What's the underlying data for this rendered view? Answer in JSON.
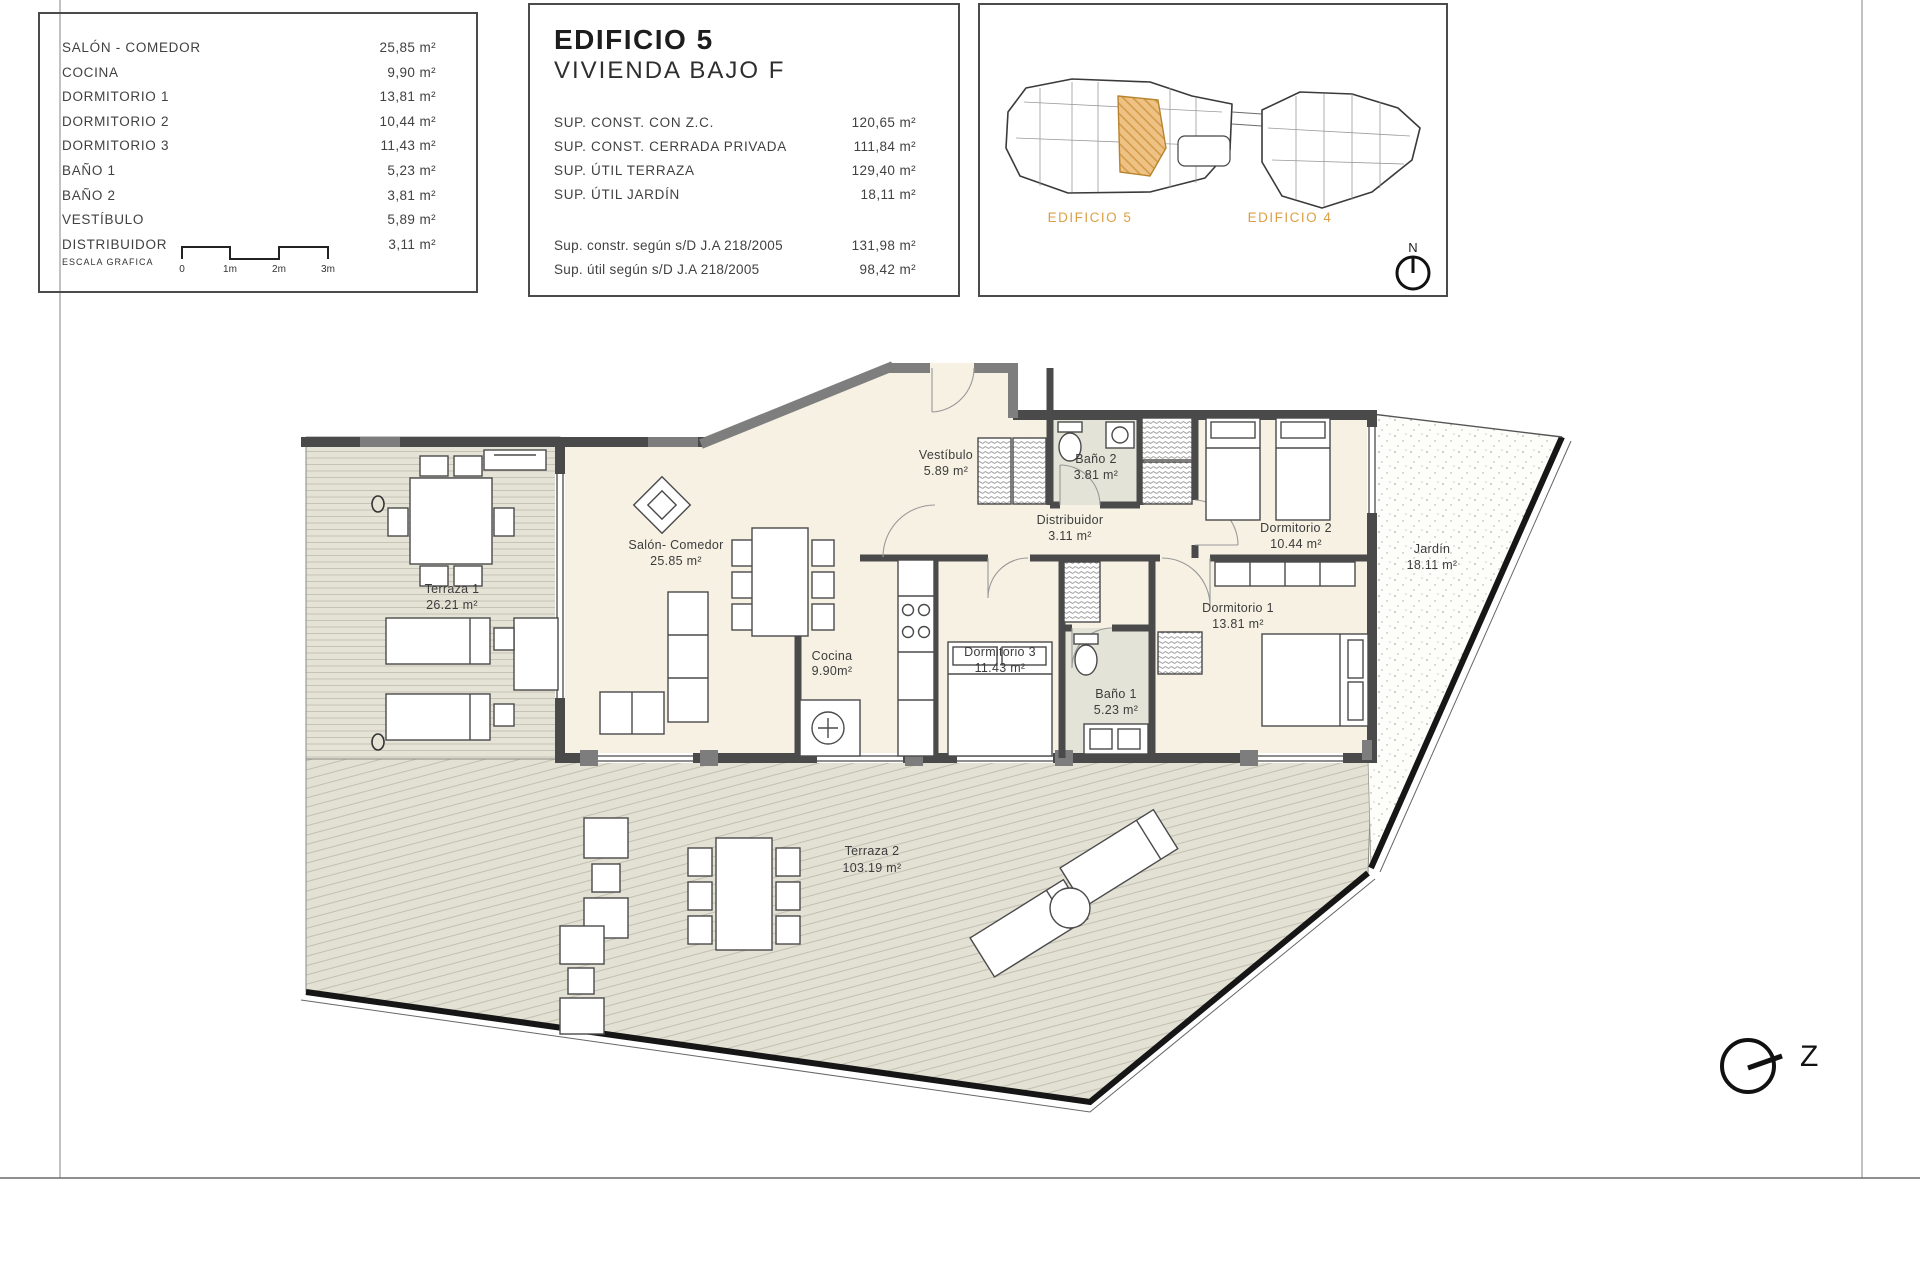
{
  "room_table": {
    "rows": [
      {
        "label": "SALÓN - COMEDOR",
        "value": "25,85 m²"
      },
      {
        "label": "COCINA",
        "value": "9,90 m²"
      },
      {
        "label": "DORMITORIO 1",
        "value": "13,81 m²"
      },
      {
        "label": "DORMITORIO 2",
        "value": "10,44 m²"
      },
      {
        "label": "DORMITORIO 3",
        "value": "11,43 m²"
      },
      {
        "label": "BAÑO 1",
        "value": "5,23 m²"
      },
      {
        "label": "BAÑO 2",
        "value": "3,81 m²"
      },
      {
        "label": "VESTÍBULO",
        "value": "5,89 m²"
      },
      {
        "label": "DISTRIBUIDOR",
        "value": "3,11 m²"
      }
    ],
    "scale": {
      "label": "ESCALA GRAFICA",
      "ticks": [
        "0",
        "1m",
        "2m",
        "3m"
      ]
    }
  },
  "info": {
    "title": "EDIFICIO 5",
    "subtitle": "VIVIENDA BAJO F",
    "rows": [
      {
        "label": "SUP. CONST. CON Z.C.",
        "value": "120,65 m²"
      },
      {
        "label": "SUP. CONST. CERRADA PRIVADA",
        "value": "111,84 m²"
      },
      {
        "label": "SUP. ÚTIL TERRAZA",
        "value": "129,40 m²"
      },
      {
        "label": "SUP. ÚTIL JARDÍN",
        "value": "18,11 m²"
      }
    ],
    "rows2": [
      {
        "label": "Sup. constr. según s/D J.A 218/2005",
        "value": "131,98 m²"
      },
      {
        "label": "Sup. útil según s/D J.A 218/2005",
        "value": "98,42 m²"
      }
    ]
  },
  "site": {
    "building_left": "EDIFICIO 5",
    "building_right": "EDIFICIO 4",
    "north_label": "N"
  },
  "plan": {
    "rooms": [
      {
        "name": "Vestíbulo",
        "area": "5.89 m²"
      },
      {
        "name": "Baño 2",
        "area": "3.81 m²"
      },
      {
        "name": "Distribuidor",
        "area": "3.11 m²"
      },
      {
        "name": "Dormitorio 2",
        "area": "10.44 m²"
      },
      {
        "name": "Salón- Comedor",
        "area": "25.85 m²"
      },
      {
        "name": "Terraza 1",
        "area": "26.21 m²"
      },
      {
        "name": "Cocina",
        "area": "9.90m²"
      },
      {
        "name": "Dormitorio 3",
        "area": "11.43 m²"
      },
      {
        "name": "Dormitorio 1",
        "area": "13.81 m²"
      },
      {
        "name": "Baño 1",
        "area": "5.23 m²"
      },
      {
        "name": "Jardín",
        "area": "18.11 m²"
      },
      {
        "name": "Terraza 2",
        "area": "103.19 m²"
      }
    ],
    "orientation_label": "Z"
  },
  "colors": {
    "wall_dark": "#4a4a4a",
    "wall_gray": "#7e7e7e",
    "floor_cream": "#f6f1e3",
    "bath_gray": "#e4e3d7",
    "deck": "#e5e2d6",
    "deck_line": "#c6c3b5",
    "accent_orange": "#dd9f43",
    "unit_highlight": "#eec184"
  }
}
